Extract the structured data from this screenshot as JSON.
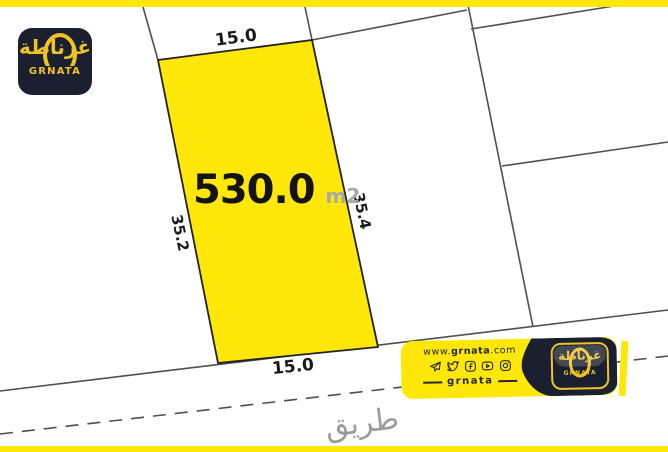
{
  "colors": {
    "accent-yellow": "#FFE70A",
    "logo-dark": "#1B2030",
    "logo-gold": "#F0C324",
    "line-gray": "#4F4F4F",
    "ink": "#1A1A1A",
    "muted": "#A9A9A9",
    "road-gray": "#9B9B9B",
    "banner-ink": "#23273A"
  },
  "brand": {
    "name_arabic": "غرناطة",
    "name_latin": "GRNATA"
  },
  "parcel": {
    "area": "530.0",
    "area_unit": "m2",
    "dim_top": "15.0",
    "dim_bottom": "15.0",
    "dim_left": "35.2",
    "dim_right": "35.4"
  },
  "road": {
    "label": "طريق"
  },
  "banner": {
    "website": {
      "prefix": "www.",
      "name": "grnata",
      "suffix": ".com"
    },
    "social": [
      "telegram",
      "twitter",
      "facebook",
      "youtube",
      "instagram"
    ],
    "handle": "grnata",
    "logo_arabic": "غرناطة",
    "logo_latin": "GRNATA"
  }
}
